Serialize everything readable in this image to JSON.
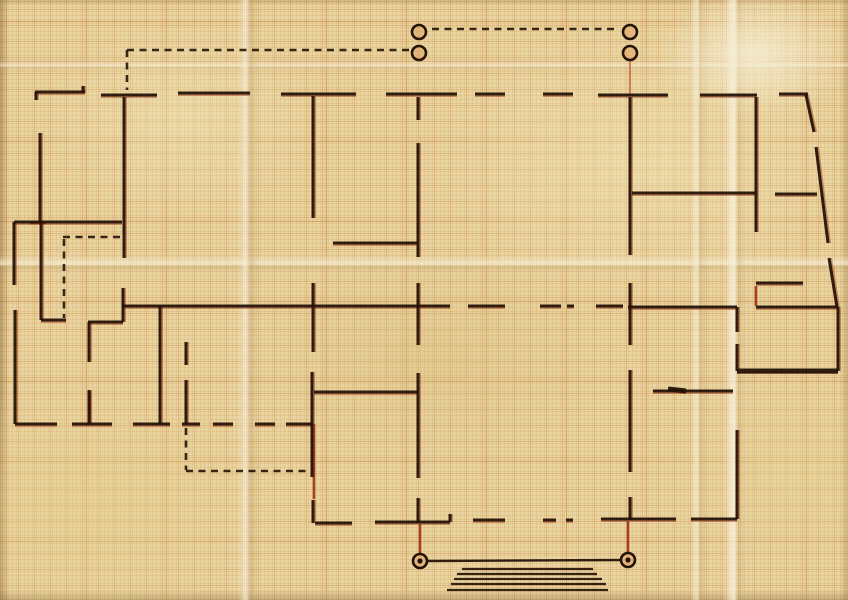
{
  "meta": {
    "kind": "hand-drawn building floor plan sketched in ink and red pencil on aged millimeter graph paper",
    "width": 848,
    "height": 600
  },
  "colors": {
    "paper": "#e8d5a2",
    "ink": "#241307",
    "red_pencil": "#9e3114",
    "orange_pencil": "#c06a3c",
    "circle_fill": "rgba(222,138,70,0.35)"
  },
  "diagram": {
    "walls": [
      [
        35,
        92,
        85,
        92
      ],
      [
        36,
        92,
        36,
        100
      ],
      [
        83,
        86,
        83,
        93
      ],
      [
        101,
        95,
        157,
        95
      ],
      [
        178,
        93,
        250,
        93
      ],
      [
        281,
        94,
        356,
        94
      ],
      [
        386,
        94,
        457,
        94
      ],
      [
        475,
        94,
        505,
        94
      ],
      [
        543,
        94,
        573,
        94
      ],
      [
        598,
        95,
        668,
        95
      ],
      [
        700,
        95,
        757,
        95
      ],
      [
        779,
        94,
        808,
        94
      ],
      [
        806,
        95,
        814,
        132
      ],
      [
        816,
        147,
        828,
        243
      ],
      [
        829,
        258,
        837,
        307
      ],
      [
        124,
        97,
        124,
        258
      ],
      [
        123,
        288,
        123,
        322
      ],
      [
        313,
        96,
        313,
        218
      ],
      [
        418,
        97,
        418,
        120
      ],
      [
        418,
        143,
        418,
        257
      ],
      [
        630,
        97,
        630,
        255
      ],
      [
        756,
        97,
        756,
        232
      ],
      [
        40,
        133,
        40,
        222
      ],
      [
        14,
        222,
        14,
        285
      ],
      [
        14,
        222,
        122,
        222
      ],
      [
        41,
        222,
        41,
        320
      ],
      [
        41,
        320,
        66,
        320
      ],
      [
        15,
        310,
        15,
        424
      ],
      [
        333,
        243,
        417,
        243
      ],
      [
        632,
        193,
        755,
        193
      ],
      [
        775,
        194,
        817,
        194
      ],
      [
        756,
        283,
        803,
        283
      ],
      [
        122,
        306,
        450,
        306
      ],
      [
        468,
        306,
        505,
        306
      ],
      [
        540,
        306,
        561,
        306
      ],
      [
        567,
        306,
        574,
        306
      ],
      [
        596,
        306,
        623,
        306
      ],
      [
        628,
        307,
        737,
        307
      ],
      [
        756,
        307,
        838,
        307
      ],
      [
        88,
        322,
        123,
        322
      ],
      [
        89,
        322,
        89,
        362
      ],
      [
        89,
        390,
        89,
        424
      ],
      [
        160,
        306,
        160,
        424
      ],
      [
        186,
        342,
        186,
        365
      ],
      [
        186,
        380,
        186,
        424
      ],
      [
        313,
        283,
        313,
        352
      ],
      [
        312,
        372,
        312,
        477
      ],
      [
        418,
        283,
        418,
        345
      ],
      [
        418,
        373,
        418,
        478
      ],
      [
        418,
        498,
        418,
        523
      ],
      [
        314,
        392,
        418,
        392
      ],
      [
        630,
        283,
        630,
        345
      ],
      [
        630,
        370,
        630,
        472
      ],
      [
        630,
        497,
        630,
        520
      ],
      [
        737,
        307,
        737,
        332
      ],
      [
        737,
        344,
        737,
        371
      ],
      [
        838,
        307,
        838,
        371
      ],
      [
        737,
        430,
        737,
        519
      ],
      [
        653,
        391,
        733,
        391
      ],
      [
        15,
        424,
        57,
        424
      ],
      [
        72,
        424,
        112,
        424
      ],
      [
        133,
        424,
        170,
        424
      ],
      [
        182,
        424,
        200,
        424
      ],
      [
        213,
        424,
        233,
        424
      ],
      [
        255,
        424,
        275,
        424
      ],
      [
        286,
        424,
        312,
        424
      ],
      [
        313,
        500,
        313,
        523
      ],
      [
        315,
        523,
        352,
        523
      ],
      [
        375,
        522,
        450,
        522
      ],
      [
        450,
        514,
        450,
        522
      ],
      [
        473,
        520,
        505,
        520
      ],
      [
        543,
        520,
        556,
        520
      ],
      [
        566,
        520,
        573,
        520
      ],
      [
        601,
        519,
        676,
        519
      ],
      [
        691,
        519,
        737,
        519
      ]
    ],
    "thick_walls": [
      [
        737,
        371,
        838,
        371
      ],
      [
        668,
        389,
        686,
        391
      ]
    ],
    "dashed_lines": [
      [
        127,
        50,
        127,
        90
      ],
      [
        127,
        50,
        411,
        50
      ],
      [
        432,
        29,
        618,
        29
      ],
      [
        63,
        237,
        122,
        237
      ],
      [
        64,
        239,
        64,
        318
      ],
      [
        186,
        428,
        186,
        470
      ],
      [
        186,
        471,
        307,
        471
      ]
    ],
    "red_strokes": [
      [
        628,
        521,
        628,
        552
      ],
      [
        420,
        524,
        420,
        553
      ],
      [
        756,
        286,
        756,
        306
      ],
      [
        30,
        223,
        46,
        223
      ],
      [
        314,
        424,
        314,
        499
      ],
      [
        90,
        391,
        90,
        423
      ]
    ],
    "orange_strokes": [
      [
        630,
        60,
        630,
        94
      ]
    ],
    "circles": {
      "radius": 7,
      "top": [
        [
          419,
          32
        ],
        [
          419,
          53
        ],
        [
          630,
          32
        ],
        [
          630,
          53
        ]
      ],
      "bottom": [
        [
          420,
          561
        ],
        [
          628,
          560
        ]
      ]
    },
    "connector": [
      427,
      561,
      621,
      560
    ],
    "stairs": [
      [
        462,
        569,
        593,
        569
      ],
      [
        457,
        574,
        597,
        574
      ],
      [
        454,
        579,
        602,
        579
      ],
      [
        451,
        584,
        606,
        584
      ],
      [
        447,
        590,
        608,
        590
      ]
    ]
  }
}
